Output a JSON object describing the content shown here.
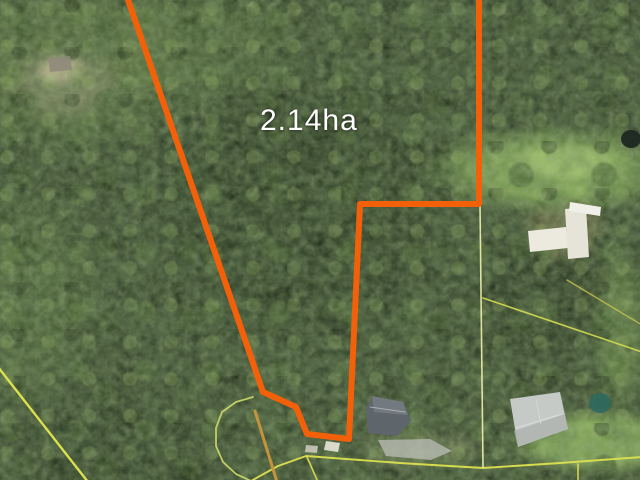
{
  "map": {
    "image_type": "aerial-satellite",
    "area_label": "2.14ha",
    "colors": {
      "boundary": "#f2600a",
      "cadastral": "#dde24f",
      "driveway": "#c9963e",
      "label_text": "#ffffff"
    },
    "boundary": {
      "name": "property-boundary",
      "area": "2.14ha",
      "stroke_width": 6,
      "points": [
        [
          126,
          -6
        ],
        [
          263,
          392
        ],
        [
          296,
          407
        ],
        [
          307,
          434
        ],
        [
          349,
          439
        ],
        [
          360,
          204
        ],
        [
          479,
          204
        ],
        [
          479,
          -6
        ]
      ]
    },
    "cadastral_lines": [
      {
        "name": "cul-de-sac-loop",
        "color": "#ccd96a",
        "width": 1.8,
        "opacity": 0.9,
        "points": [
          [
            253,
            397
          ],
          [
            236,
            402
          ],
          [
            222,
            412
          ],
          [
            216,
            428
          ],
          [
            216,
            446
          ],
          [
            223,
            462
          ],
          [
            236,
            474
          ],
          [
            251,
            481
          ]
        ]
      },
      {
        "name": "road-line",
        "color": "#dde24f",
        "width": 1.9,
        "opacity": 0.95,
        "points": [
          [
            251,
            481
          ],
          [
            278,
            466
          ],
          [
            306,
            456
          ],
          [
            400,
            463
          ],
          [
            483,
            468
          ],
          [
            560,
            463
          ],
          [
            642,
            457
          ]
        ]
      },
      {
        "name": "road-spur",
        "color": "#dde24f",
        "width": 1.6,
        "opacity": 0.9,
        "points": [
          [
            307,
            457
          ],
          [
            318,
            482
          ]
        ]
      },
      {
        "name": "east-lot-line",
        "color": "#eef2ad",
        "width": 1.6,
        "opacity": 0.9,
        "points": [
          [
            480,
            205
          ],
          [
            483,
            467
          ]
        ]
      },
      {
        "name": "south-lot-spur",
        "color": "#dde24f",
        "width": 1.6,
        "opacity": 0.9,
        "points": [
          [
            578,
            464
          ],
          [
            578,
            482
          ]
        ]
      },
      {
        "name": "southeast-lot-line",
        "color": "#d5de52",
        "width": 1.6,
        "opacity": 0.9,
        "points": [
          [
            483,
            298
          ],
          [
            642,
            352
          ]
        ]
      },
      {
        "name": "northeast-lot-line",
        "color": "#c9c44e",
        "width": 1.4,
        "opacity": 0.8,
        "points": [
          [
            567,
            280
          ],
          [
            642,
            325
          ]
        ]
      },
      {
        "name": "west-road-line",
        "color": "#e3e74e",
        "width": 2.4,
        "opacity": 0.95,
        "points": [
          [
            -2,
            367
          ],
          [
            88,
            482
          ]
        ]
      },
      {
        "name": "driveway-track",
        "color": "#c9963e",
        "width": 3,
        "opacity": 0.95,
        "points": [
          [
            255,
            411
          ],
          [
            277,
            482
          ]
        ]
      }
    ],
    "features": {
      "polygons": [
        {
          "name": "house-bottom-center-roof",
          "fill": "#5f666b",
          "opacity": 1,
          "points": [
            [
              372,
              396
            ],
            [
              403,
              402
            ],
            [
              411,
              421
            ],
            [
              397,
              436
            ],
            [
              368,
              433
            ],
            [
              366,
              409
            ]
          ]
        },
        {
          "name": "house-bottom-center-roof-facet",
          "fill": "#848b90",
          "opacity": 0.55,
          "points": [
            [
              372,
              396
            ],
            [
              403,
              402
            ],
            [
              408,
              415
            ],
            [
              374,
              412
            ]
          ]
        },
        {
          "name": "driveway-pad",
          "fill": "#b6bab0",
          "opacity": 0.8,
          "points": [
            [
              378,
              440
            ],
            [
              430,
              439
            ],
            [
              452,
              451
            ],
            [
              431,
              460
            ],
            [
              386,
              456
            ]
          ]
        },
        {
          "name": "shed-small-1",
          "fill": "#e8e6da",
          "opacity": 0.9,
          "points": [
            [
              326,
              441
            ],
            [
              340,
              443
            ],
            [
              338,
              452
            ],
            [
              324,
              450
            ]
          ]
        },
        {
          "name": "shed-small-2",
          "fill": "#d8d5c8",
          "opacity": 0.8,
          "points": [
            [
              306,
              445
            ],
            [
              318,
              446
            ],
            [
              317,
              453
            ],
            [
              305,
              452
            ]
          ]
        },
        {
          "name": "house-bottom-right-roof",
          "fill": "#c6cac7",
          "opacity": 1,
          "points": [
            [
              510,
              399
            ],
            [
              560,
              392
            ],
            [
              568,
              429
            ],
            [
              518,
              447
            ]
          ]
        },
        {
          "name": "house-bottom-right-roof-shade",
          "fill": "#a9afac",
          "opacity": 0.7,
          "points": [
            [
              518,
              447
            ],
            [
              568,
              429
            ],
            [
              565,
              414
            ],
            [
              514,
              431
            ]
          ]
        },
        {
          "name": "shed-white-1",
          "fill": "#eceadf",
          "opacity": 1,
          "points": [
            [
              528,
              231
            ],
            [
              566,
              227
            ],
            [
              568,
              248
            ],
            [
              530,
              252
            ]
          ]
        },
        {
          "name": "shed-white-2",
          "fill": "#e6e4d8",
          "opacity": 1,
          "points": [
            [
              565,
              209
            ],
            [
              586,
              207
            ],
            [
              589,
              257
            ],
            [
              568,
              259
            ]
          ]
        },
        {
          "name": "shed-white-3",
          "fill": "#f0efe8",
          "opacity": 1,
          "points": [
            [
              570,
              202
            ],
            [
              601,
              207
            ],
            [
              600,
              216
            ],
            [
              569,
              211
            ]
          ]
        },
        {
          "name": "clearing-shed",
          "fill": "#8f897a",
          "opacity": 0.9,
          "points": [
            [
              48,
              58
            ],
            [
              70,
              56
            ],
            [
              72,
              70
            ],
            [
              50,
              72
            ]
          ]
        }
      ],
      "ellipses": [
        {
          "name": "pool",
          "fill": "#2e6a5e",
          "opacity": 0.9,
          "cx": 600,
          "cy": 403,
          "rx": 11,
          "ry": 10
        },
        {
          "name": "water-tank",
          "fill": "#1d2822",
          "opacity": 0.95,
          "cx": 631,
          "cy": 139,
          "rx": 10,
          "ry": 9
        }
      ],
      "ridge_lines": [
        {
          "name": "roof-ridge-long",
          "color": "#dadedb",
          "width": 1.2,
          "opacity": 0.8,
          "points": [
            [
              516,
              428
            ],
            [
              562,
              414
            ]
          ]
        },
        {
          "name": "roof-ridge-cross",
          "color": "#dadedb",
          "width": 1,
          "opacity": 0.7,
          "points": [
            [
              536,
              400
            ],
            [
              541,
              424
            ]
          ]
        },
        {
          "name": "house-dark-ridge",
          "color": "#b9bfc2",
          "width": 1,
          "opacity": 0.8,
          "points": [
            [
              370,
              407
            ],
            [
              405,
              412
            ]
          ]
        }
      ]
    }
  }
}
